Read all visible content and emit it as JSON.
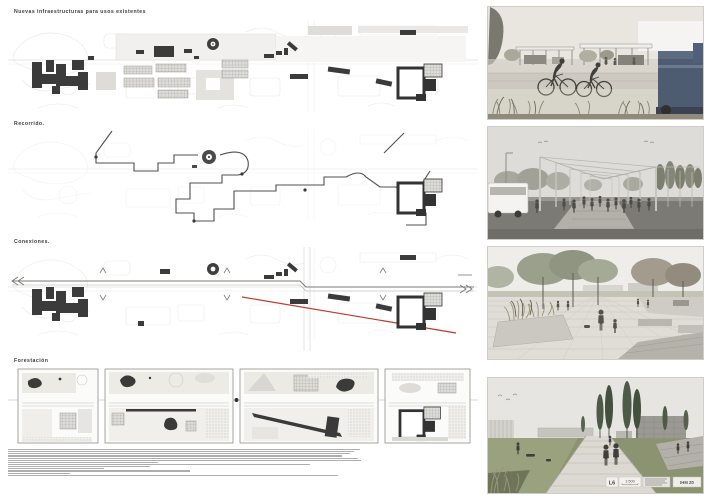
{
  "titles": {
    "infraestructuras": "Nuevas infraestructuras para usos existentes",
    "recorrido": "Recorrido.",
    "conexiones": "Conexiones.",
    "forestacion": "Forestación"
  },
  "titleblock": {
    "sheet": "L6",
    "scale": "1:500",
    "code": "IHM Z0"
  },
  "fine_print": {
    "note": "illegible micro-text project memoria (Spanish)",
    "line_widths": [
      352,
      346,
      342,
      334,
      350,
      353,
      150,
      302,
      142,
      96,
      182,
      62,
      330
    ]
  },
  "renders": [
    {
      "name": "tram-stop-cycleway"
    },
    {
      "name": "pergola-promenade"
    },
    {
      "name": "tree-plaza"
    },
    {
      "name": "lawn-path-cypresses"
    }
  ],
  "colors": {
    "accent_red": "#c0392b",
    "building_dark": "#3a3a3a",
    "vehicle_blue": "#4e5c72"
  }
}
